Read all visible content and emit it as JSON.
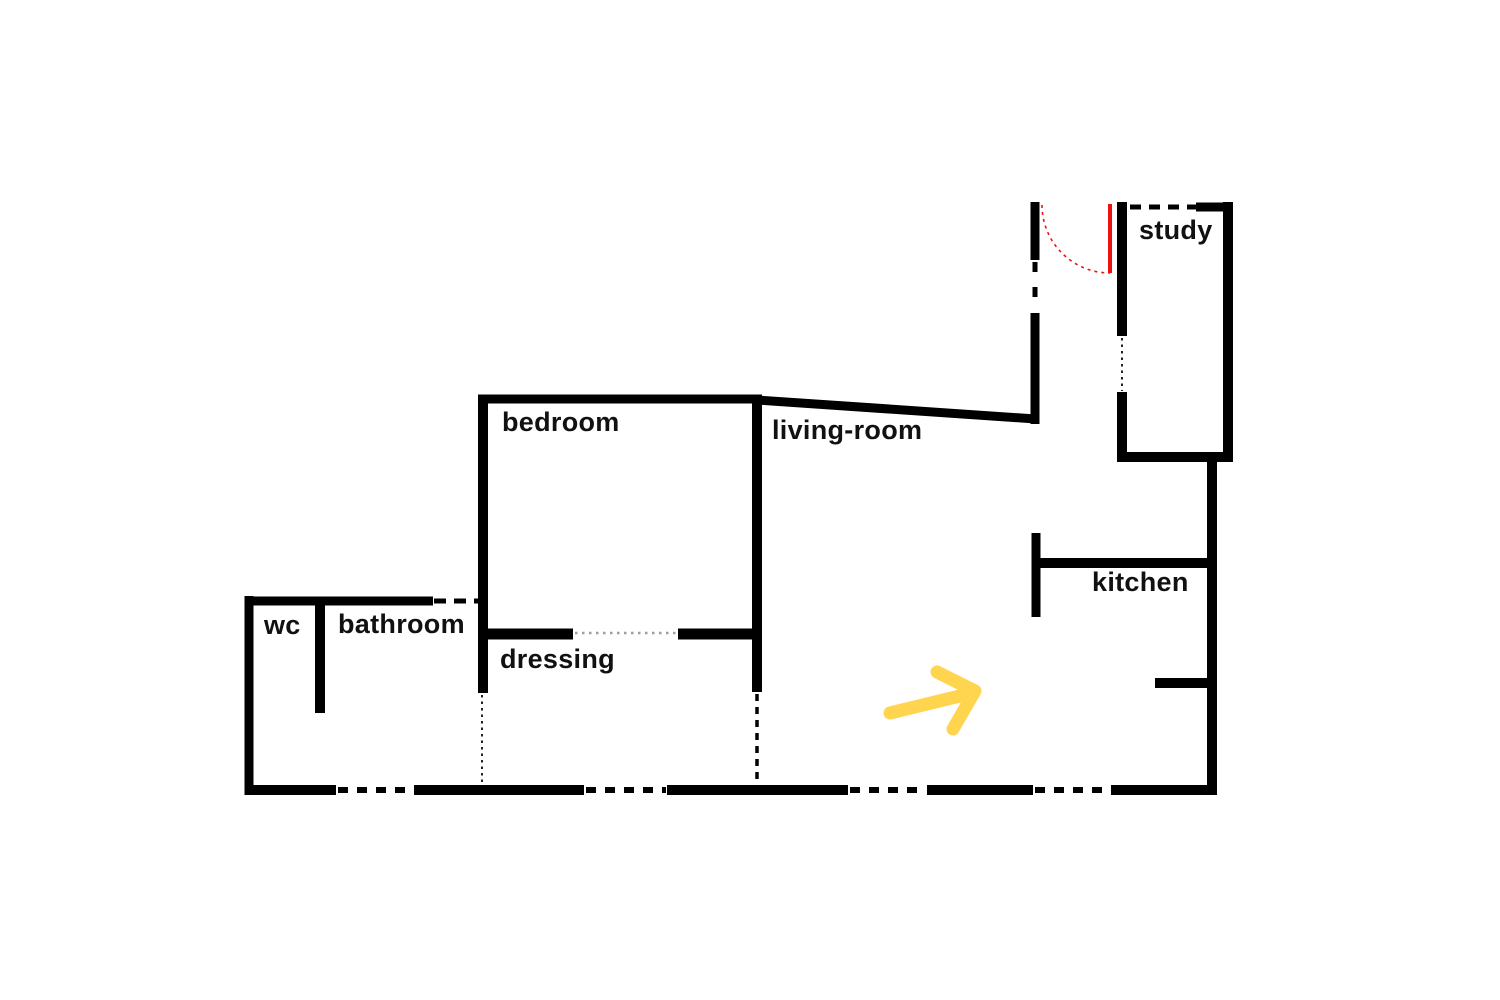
{
  "canvas": {
    "width": 1500,
    "height": 1000,
    "background": "#ffffff"
  },
  "colors": {
    "wall": "#000000",
    "opening_dash": "#000000",
    "fine_dot": "#222222",
    "gray_dot": "#9e9e9e",
    "door": "#ee1111",
    "arrow": "#ffd44f",
    "label_text": "#111111"
  },
  "labels": [
    {
      "id": "study",
      "text": "study",
      "x": 1139,
      "y": 216
    },
    {
      "id": "bedroom",
      "text": "bedroom",
      "x": 502,
      "y": 408
    },
    {
      "id": "living-room",
      "text": "living-room",
      "x": 772,
      "y": 416
    },
    {
      "id": "kitchen",
      "text": "kitchen",
      "x": 1092,
      "y": 568
    },
    {
      "id": "wc",
      "text": "wc",
      "x": 264,
      "y": 611
    },
    {
      "id": "bathroom",
      "text": "bathroom",
      "x": 338,
      "y": 610
    },
    {
      "id": "dressing",
      "text": "dressing",
      "x": 500,
      "y": 645
    }
  ],
  "walls": {
    "solid": [
      {
        "name": "bathroom-top-wall",
        "x1": 245,
        "y1": 601,
        "x2": 433,
        "y2": 601,
        "w": 9
      },
      {
        "name": "outer-left-wall",
        "x1": 249,
        "y1": 596,
        "x2": 249,
        "y2": 795,
        "w": 9
      },
      {
        "name": "wc-divider-wall",
        "x1": 320,
        "y1": 597,
        "x2": 320,
        "y2": 713,
        "w": 10
      },
      {
        "name": "outer-bottom-wall-1",
        "x1": 245,
        "y1": 790,
        "x2": 336,
        "y2": 790,
        "w": 10
      },
      {
        "name": "outer-bottom-wall-2",
        "x1": 414,
        "y1": 790,
        "x2": 584,
        "y2": 790,
        "w": 10
      },
      {
        "name": "outer-bottom-wall-3",
        "x1": 667,
        "y1": 790,
        "x2": 848,
        "y2": 790,
        "w": 10
      },
      {
        "name": "outer-bottom-wall-4",
        "x1": 927,
        "y1": 790,
        "x2": 1033,
        "y2": 790,
        "w": 10
      },
      {
        "name": "outer-bottom-wall-5",
        "x1": 1111,
        "y1": 790,
        "x2": 1217,
        "y2": 790,
        "w": 10
      },
      {
        "name": "bedroom-top-wall",
        "x1": 478,
        "y1": 399,
        "x2": 762,
        "y2": 399,
        "w": 9
      },
      {
        "name": "bedroom-left-wall",
        "x1": 483,
        "y1": 395,
        "x2": 483,
        "y2": 693,
        "w": 10
      },
      {
        "name": "bedroom-right-wall",
        "x1": 757,
        "y1": 395,
        "x2": 757,
        "y2": 692,
        "w": 10
      },
      {
        "name": "living-room-slanted-wall",
        "x1": 757,
        "y1": 400,
        "x2": 1036,
        "y2": 419,
        "w": 9
      },
      {
        "name": "dressing-divider-left",
        "x1": 478,
        "y1": 634,
        "x2": 573,
        "y2": 634,
        "w": 11
      },
      {
        "name": "dressing-divider-right",
        "x1": 678,
        "y1": 634,
        "x2": 762,
        "y2": 634,
        "w": 11
      },
      {
        "name": "entry-wall-upper",
        "x1": 1035,
        "y1": 202,
        "x2": 1035,
        "y2": 260,
        "w": 9
      },
      {
        "name": "entry-wall-lower",
        "x1": 1035,
        "y1": 313,
        "x2": 1035,
        "y2": 424,
        "w": 9
      },
      {
        "name": "study-left-wall-upper",
        "x1": 1122,
        "y1": 202,
        "x2": 1122,
        "y2": 336,
        "w": 10
      },
      {
        "name": "study-left-wall-lower",
        "x1": 1122,
        "y1": 392,
        "x2": 1122,
        "y2": 462,
        "w": 10
      },
      {
        "name": "study-top-right-wall",
        "x1": 1196,
        "y1": 207,
        "x2": 1233,
        "y2": 207,
        "w": 9
      },
      {
        "name": "study-right-wall",
        "x1": 1228,
        "y1": 202,
        "x2": 1228,
        "y2": 462,
        "w": 10
      },
      {
        "name": "study-bottom-wall",
        "x1": 1117,
        "y1": 457,
        "x2": 1233,
        "y2": 457,
        "w": 10
      },
      {
        "name": "outer-right-wall",
        "x1": 1212,
        "y1": 457,
        "x2": 1212,
        "y2": 795,
        "w": 10
      },
      {
        "name": "kitchen-left-wall",
        "x1": 1036,
        "y1": 533,
        "x2": 1036,
        "y2": 617,
        "w": 9
      },
      {
        "name": "kitchen-top-wall",
        "x1": 1032,
        "y1": 563,
        "x2": 1217,
        "y2": 563,
        "w": 10
      },
      {
        "name": "kitchen-stub-wall",
        "x1": 1155,
        "y1": 683,
        "x2": 1217,
        "y2": 683,
        "w": 10
      }
    ],
    "dashed": [
      {
        "name": "bathroom-top-opening",
        "x1": 434,
        "y1": 601,
        "x2": 478,
        "y2": 601,
        "w": 5,
        "dash": "12 8"
      },
      {
        "name": "bottom-opening-1",
        "x1": 338,
        "y1": 790,
        "x2": 413,
        "y2": 790,
        "w": 6,
        "dash": "10 9"
      },
      {
        "name": "bottom-opening-2",
        "x1": 586,
        "y1": 790,
        "x2": 666,
        "y2": 790,
        "w": 6,
        "dash": "10 9"
      },
      {
        "name": "bottom-opening-3",
        "x1": 850,
        "y1": 790,
        "x2": 926,
        "y2": 790,
        "w": 6,
        "dash": "10 9"
      },
      {
        "name": "bottom-opening-4",
        "x1": 1035,
        "y1": 790,
        "x2": 1110,
        "y2": 790,
        "w": 6,
        "dash": "10 9"
      },
      {
        "name": "study-top-opening",
        "x1": 1130,
        "y1": 207,
        "x2": 1196,
        "y2": 207,
        "w": 5,
        "dash": "11 8"
      },
      {
        "name": "entry-opening",
        "x1": 1035,
        "y1": 262,
        "x2": 1035,
        "y2": 311,
        "w": 5,
        "dash": "10 15"
      },
      {
        "name": "dressing-right-opening",
        "x1": 757,
        "y1": 694,
        "x2": 757,
        "y2": 786,
        "w": 3.5,
        "dash": "7 6"
      }
    ],
    "dotted": [
      {
        "name": "study-left-window",
        "x1": 1122,
        "y1": 338,
        "x2": 1122,
        "y2": 391,
        "w": 2,
        "dash": "2.5 4",
        "color_key": "fine_dot"
      },
      {
        "name": "dressing-left-dotted",
        "x1": 482,
        "y1": 695,
        "x2": 482,
        "y2": 785,
        "w": 2,
        "dash": "2.5 4",
        "color_key": "fine_dot"
      },
      {
        "name": "dressing-divider-dotted",
        "x1": 575,
        "y1": 633,
        "x2": 677,
        "y2": 633,
        "w": 2.5,
        "dash": "2.5 4.5",
        "color_key": "gray_dot"
      }
    ]
  },
  "door": {
    "leaf": {
      "x1": 1110,
      "y1": 204,
      "x2": 1110,
      "y2": 273,
      "w": 4
    },
    "swing_arc": {
      "start_x": 1042,
      "start_y": 205,
      "end_x": 1110,
      "end_y": 273,
      "radius": 68,
      "w": 1.6,
      "dash": "3 4"
    }
  },
  "arrow": {
    "shaft": [
      [
        890,
        713
      ],
      [
        968,
        694
      ]
    ],
    "head": [
      [
        937,
        672
      ],
      [
        975,
        691
      ],
      [
        953,
        729
      ]
    ],
    "stroke_width": 13
  }
}
